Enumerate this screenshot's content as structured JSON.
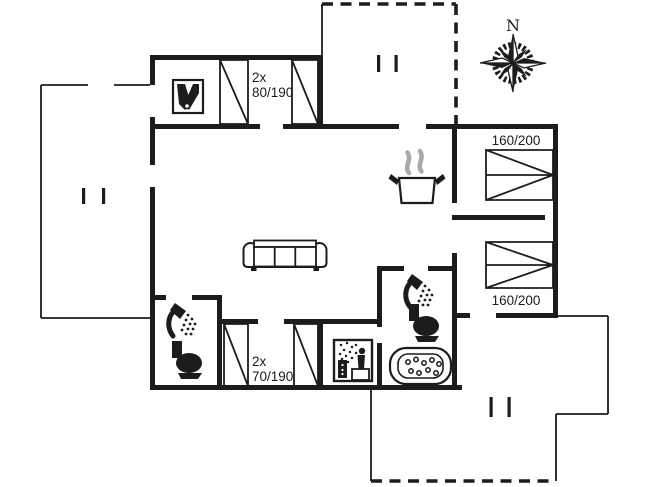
{
  "colors": {
    "ink": "#1c1c1c",
    "background": "#ffffff",
    "steam": "#a9a9a9"
  },
  "labels": {
    "bedroom_top_count": "2x",
    "bedroom_top_size": "80/190",
    "bedroom_right_top_size": "160/200",
    "bedroom_right_bottom_size": "160/200",
    "bedroom_bottom_count": "2x",
    "bedroom_bottom_size": "70/190",
    "compass_north": "N"
  },
  "icons": {
    "compass": "compass-rose-icon",
    "wood_stove": "wood-stove-icon",
    "cooking_pot": "cooking-pot-steam-icon",
    "sofa": "sofa-icon",
    "shower": "shower-icon",
    "toilet": "toilet-icon",
    "sauna": "sauna-icon",
    "spa_bath": "spa-bath-icon",
    "single_bed": "single-bed-icon",
    "double_bed": "double-bed-icon",
    "door_opening": "opening-ticks-icon",
    "terrace": "terrace-dashed-outline"
  }
}
